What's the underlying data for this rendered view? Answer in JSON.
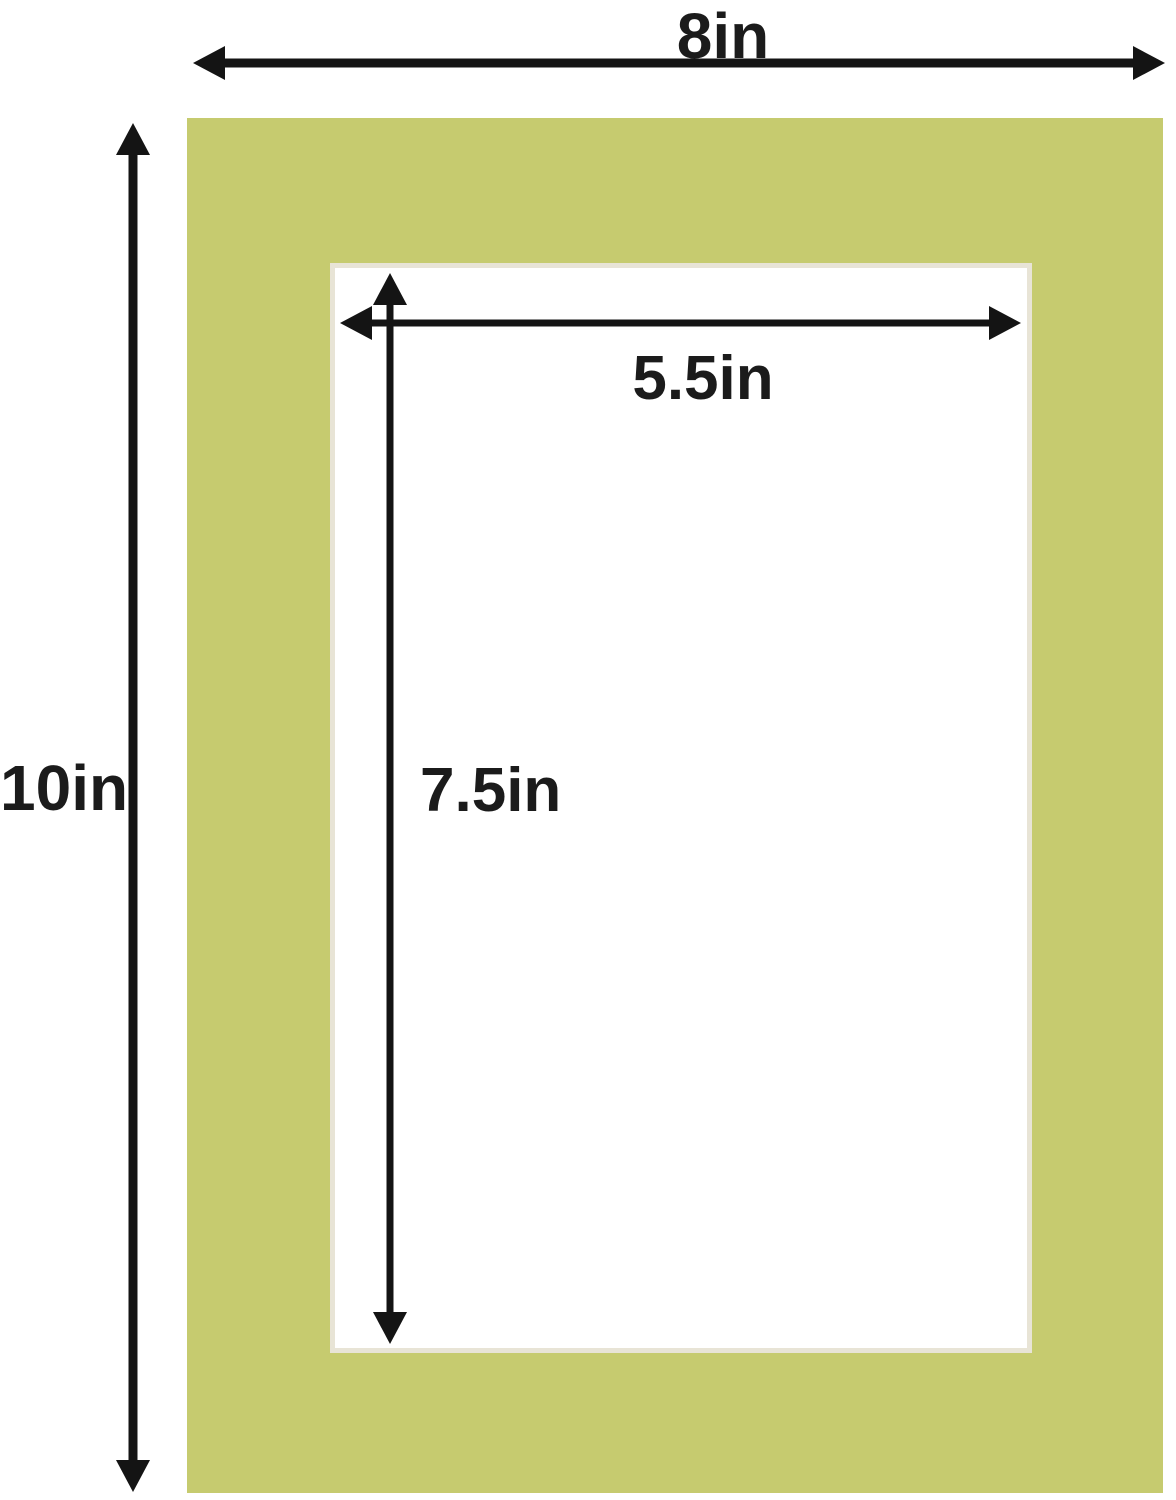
{
  "diagram": {
    "description": "Picture frame mat board with outer and opening dimension arrows",
    "dimensions": {
      "outer_width": "8in",
      "outer_height": "10in",
      "opening_width": "5.5in",
      "opening_height": "7.5in"
    },
    "colors": {
      "mat": "#c6cb6f",
      "bevel": "#e8e4d6",
      "arrow": "#141414",
      "text": "#1b1b1b",
      "background": "#ffffff"
    }
  }
}
